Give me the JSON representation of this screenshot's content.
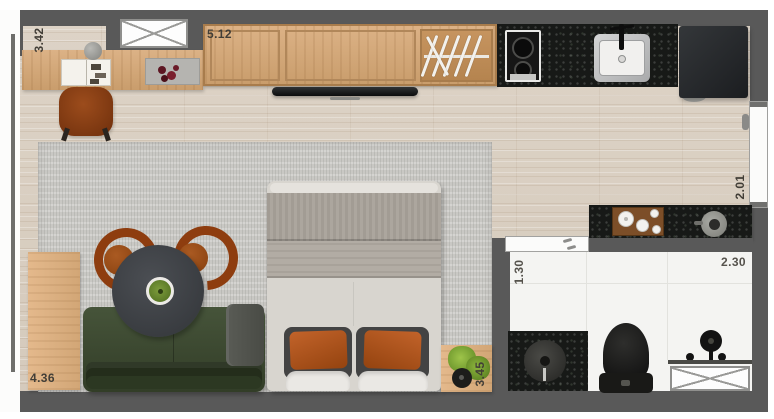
{
  "dimensions": {
    "desk_side": "3.42",
    "top_wall": "5.12",
    "entry_side": "2.01",
    "bathroom_depth": "1.30",
    "bathroom_width": "2.30",
    "living_side": "4.36",
    "bed_side": "3.45"
  },
  "colors": {
    "wall": "#595959",
    "counter-granite": "#171917",
    "label-text": "#423e37",
    "floor-wood": "#d9cfc2",
    "cabinet-wood": "#d4aa7b",
    "rug-gray": "#c9c8c4",
    "sofa-green": "#3b4730",
    "table-charcoal": "#3e4146",
    "chair-cognac": "#9c4c18",
    "pillow-rust": "#b2551e",
    "appliance-dark": "#27292c",
    "bathroom-floor": "#f4f4f2",
    "fixture-black": "#161616",
    "plant-green": "#7fae36"
  },
  "furniture_icons": [
    "desk",
    "desk-chair",
    "open-book",
    "decor-tray",
    "decor-sphere",
    "wardrobe",
    "clothes-hangers",
    "tv",
    "cooktop",
    "kitchen-sink",
    "refrigerator",
    "entry-door",
    "bar-counter",
    "serving-tray",
    "bar-sink",
    "bathroom-sliding-door",
    "vanity-basin",
    "toilet",
    "shower-set",
    "bathroom-window",
    "top-window",
    "glass-wall",
    "rug",
    "sideboard",
    "sofa",
    "throw-blanket",
    "round-dining-table",
    "table-plant",
    "dining-chair",
    "bed",
    "pillows",
    "plant-side-table"
  ]
}
